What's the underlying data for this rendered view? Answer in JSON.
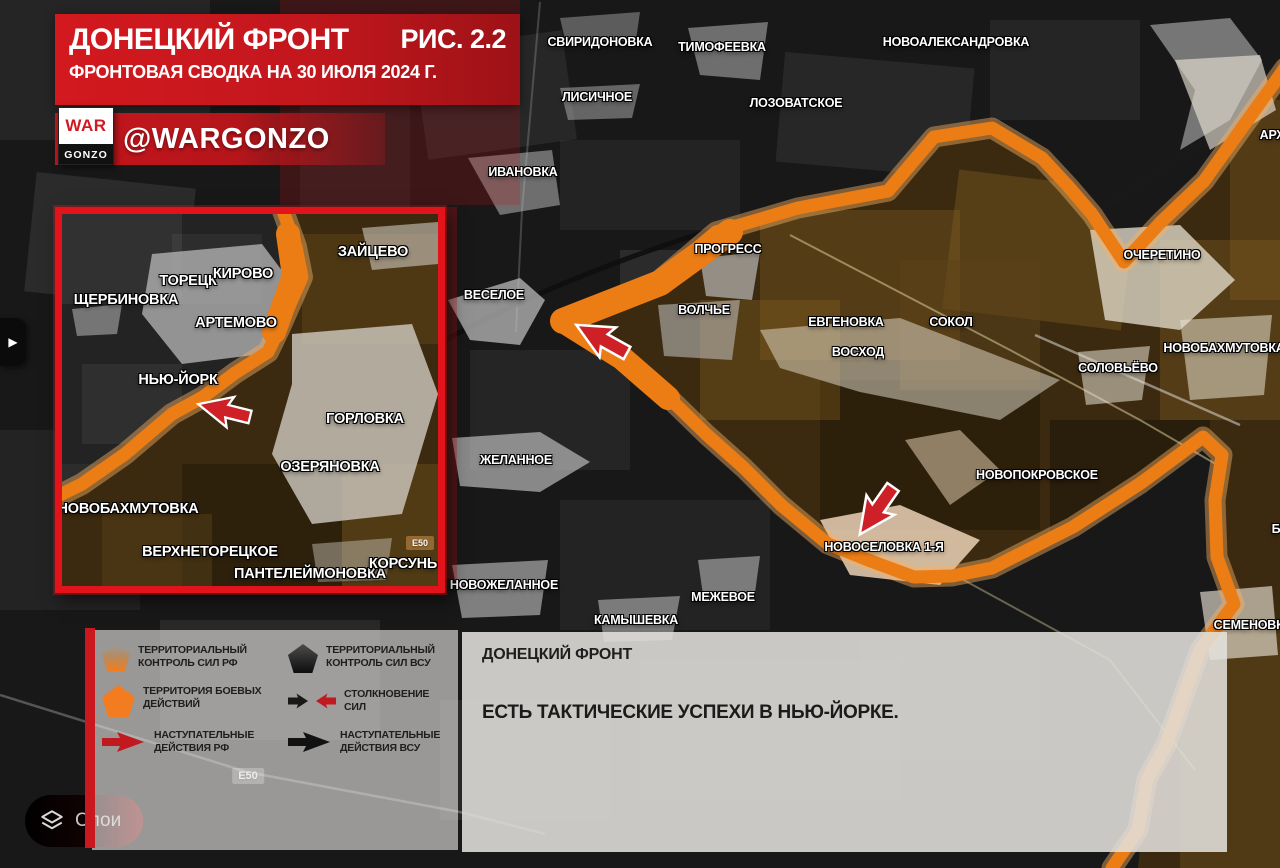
{
  "header": {
    "title": "ДОНЕЦКИЙ ФРОНТ",
    "figure": "РИС. 2.2",
    "subtitle": "ФРОНТОВАЯ СВОДКА НА 30 ИЮЛЯ 2024 Г."
  },
  "branding": {
    "logo_top": "WAR",
    "logo_bottom": "GONZO",
    "handle": "@WARGONZO"
  },
  "colors": {
    "accent_red": "#c9181e",
    "front_orange": "#ec7d15",
    "rf_area_brown": "#3b2a10",
    "panel_gray": "#e7e5e1"
  },
  "main_map": {
    "road_badge": "Е50",
    "labels": [
      {
        "text": "СВИРИДОНОВКА"
      },
      {
        "text": "ТИМОФЕЕВКА"
      },
      {
        "text": "НОВОАЛЕКСАНДРОВКА"
      },
      {
        "text": "ЛИСИЧНОЕ"
      },
      {
        "text": "ЛОЗОВАТСКОЕ"
      },
      {
        "text": "ИВАНОВКА"
      },
      {
        "text": "ПРОГРЕСС"
      },
      {
        "text": "ВЕСЕЛОЕ"
      },
      {
        "text": "ВОЛЧЬЕ"
      },
      {
        "text": "ЕВГЕНОВКА"
      },
      {
        "text": "СОКОЛ"
      },
      {
        "text": "ВОСХОД"
      },
      {
        "text": "ОЧЕРЕТИНО"
      },
      {
        "text": "НОВОБАХМУТОВКА"
      },
      {
        "text": "СОЛОВЬЁВО"
      },
      {
        "text": "ЖЕЛАННОЕ"
      },
      {
        "text": "НОВОПОКРОВСКОЕ"
      },
      {
        "text": "НОВОСЕЛОВКА 1-Я"
      },
      {
        "text": "НОВОЖЕЛАННОЕ"
      },
      {
        "text": "МЕЖЕВОЕ"
      },
      {
        "text": "КАМЫШЕВКА"
      },
      {
        "text": "СЕМЕНОВКА"
      },
      {
        "text": "АРХ"
      },
      {
        "text": "Б"
      }
    ]
  },
  "inset_map": {
    "road_badge": "E50",
    "labels": [
      {
        "text": "ЗАЙЦЕВО"
      },
      {
        "text": "ТОРЕЦК"
      },
      {
        "text": "КИРОВО"
      },
      {
        "text": "ЩЕРБИНОВКА"
      },
      {
        "text": "АРТЕМОВО"
      },
      {
        "text": "НЬЮ-ЙОРК"
      },
      {
        "text": "ГОРЛОВКА"
      },
      {
        "text": "ОЗЕРЯНОВКА"
      },
      {
        "text": "НОВОБАХМУТОВКА"
      },
      {
        "text": "ВЕРХНЕТОРЕЦКОЕ"
      },
      {
        "text": "ПАНТЕЛЕЙМОНОВКА"
      },
      {
        "text": "КОРСУНЬ"
      }
    ]
  },
  "legend": {
    "items": [
      {
        "icon": "pentagon-rf-control-icon",
        "label": "ТЕРРИТОРИАЛЬНЫЙ\nКОНТРОЛЬ СИЛ РФ"
      },
      {
        "icon": "pentagon-vsu-control-icon",
        "label": "ТЕРРИТОРИАЛЬНЫЙ\nКОНТРОЛЬ СИЛ ВСУ"
      },
      {
        "icon": "pentagon-combat-zone-icon",
        "label": "ТЕРРИТОРИЯ БОЕВЫХ\nДЕЙСТВИЙ"
      },
      {
        "icon": "clash-arrows-icon",
        "label": "СТОЛКНОВЕНИЕ СИЛ"
      },
      {
        "icon": "rf-advance-arrow-icon",
        "label": "НАСТУПАТЕЛЬНЫЕ\nДЕЙСТВИЯ РФ"
      },
      {
        "icon": "vsu-advance-arrow-icon",
        "label": "НАСТУПАТЕЛЬНЫЕ\nДЕЙСТВИЯ ВСУ"
      }
    ]
  },
  "info_box": {
    "title": "ДОНЕЦКИЙ ФРОНТ",
    "message": "ЕСТЬ ТАКТИЧЕСКИЕ УСПЕХИ В НЬЮ-ЙОРКЕ."
  },
  "controls": {
    "layers_label": "Слои",
    "expand_arrow": "▶"
  }
}
